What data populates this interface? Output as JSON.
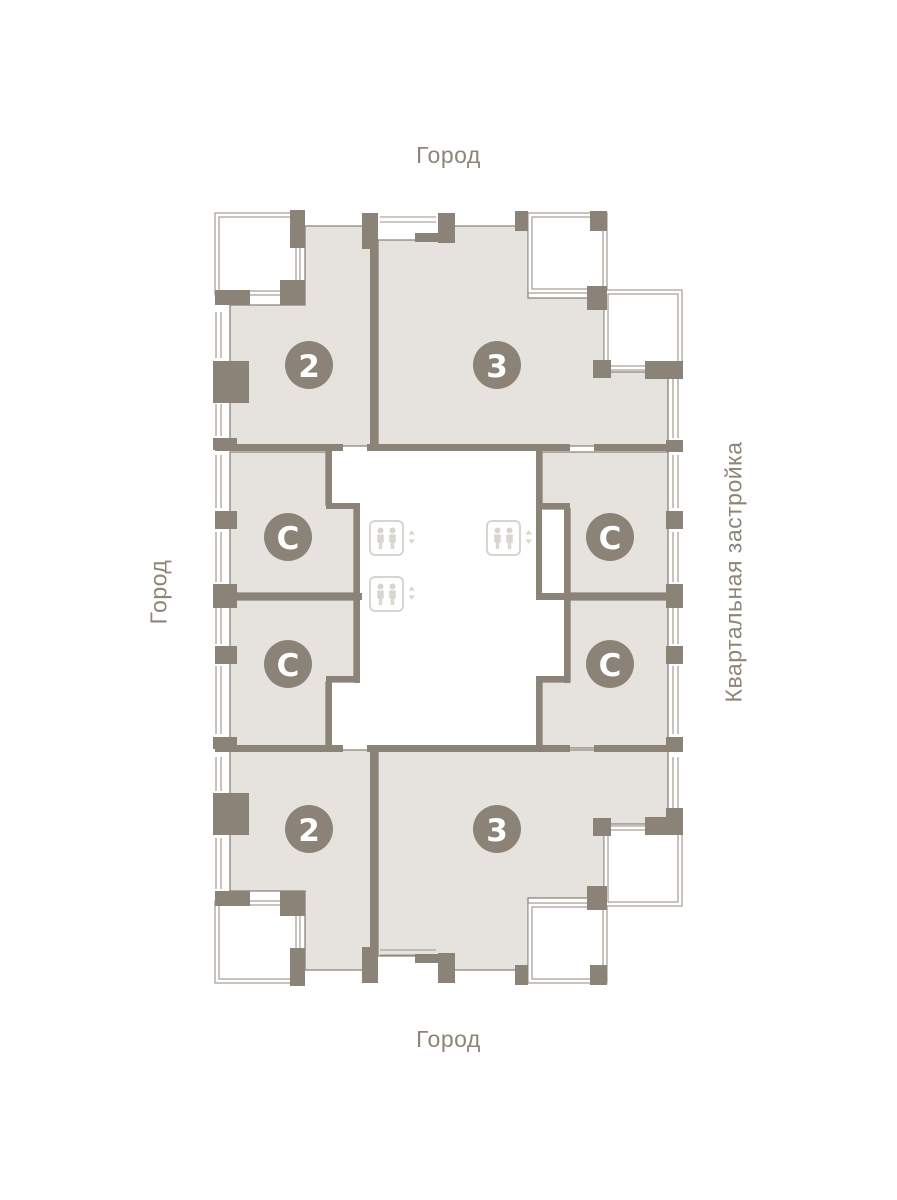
{
  "page": {
    "background": "#ffffff"
  },
  "theme": {
    "wall_color": "#8b8278",
    "apartment_fill": "#e6e3de",
    "thin_line_color": "#9a928a",
    "elevator_icon_color": "#d8d5cf",
    "label_color": "#8d857b",
    "badge_bg": "#8b8278",
    "badge_text_color": "#ffffff"
  },
  "orientation_labels": {
    "top": "Город",
    "bottom": "Город",
    "left": "Город",
    "right": "Квартальная застройка"
  },
  "floor_plan": {
    "badge_radius": 24,
    "apartments": [
      {
        "id": "apartment-2-top-left",
        "label": "2",
        "badge": {
          "cx": 309,
          "cy": 365
        }
      },
      {
        "id": "apartment-3-top-right",
        "label": "3",
        "badge": {
          "cx": 497,
          "cy": 365
        }
      },
      {
        "id": "apartment-s-mid-left-upper",
        "label": "С",
        "badge": {
          "cx": 288,
          "cy": 537
        }
      },
      {
        "id": "apartment-s-mid-right-upper",
        "label": "С",
        "badge": {
          "cx": 610,
          "cy": 537
        }
      },
      {
        "id": "apartment-s-mid-left-lower",
        "label": "С",
        "badge": {
          "cx": 288,
          "cy": 664
        }
      },
      {
        "id": "apartment-s-mid-right-lower",
        "label": "С",
        "badge": {
          "cx": 610,
          "cy": 664
        }
      },
      {
        "id": "apartment-2-bottom-left",
        "label": "2",
        "badge": {
          "cx": 309,
          "cy": 829
        }
      },
      {
        "id": "apartment-3-bottom-right",
        "label": "3",
        "badge": {
          "cx": 497,
          "cy": 829
        }
      }
    ],
    "elevators": [
      {
        "x": 370,
        "y": 521
      },
      {
        "x": 370,
        "y": 577
      },
      {
        "x": 487,
        "y": 521
      }
    ]
  }
}
